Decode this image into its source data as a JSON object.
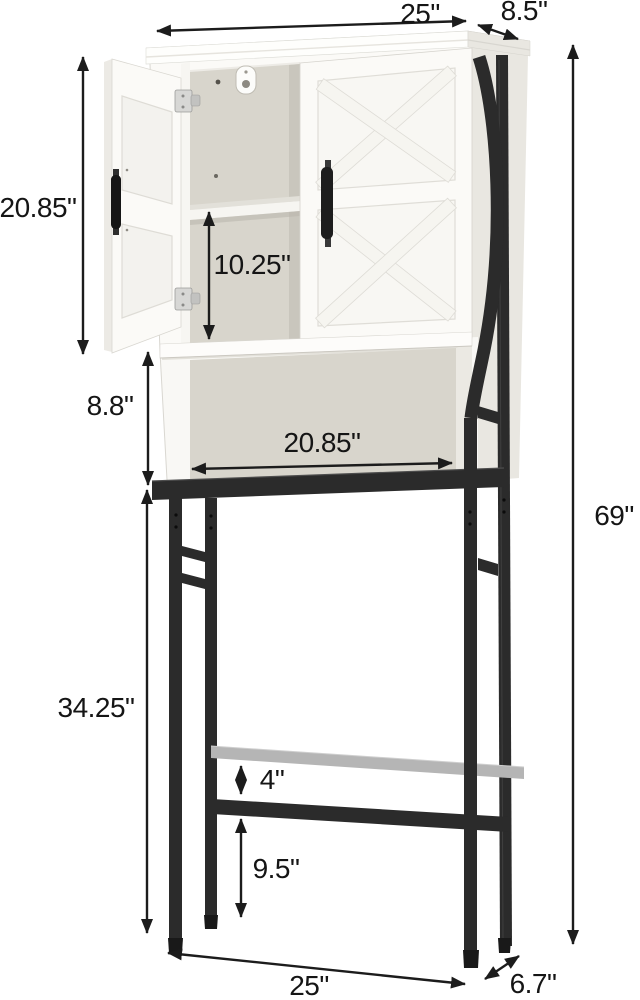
{
  "dims": {
    "top_width": "25\"",
    "top_depth": "8.5\"",
    "cabinet_height": "20.85\"",
    "interior_shelf_height": "10.25\"",
    "open_shelf_height": "8.8\"",
    "open_shelf_width": "20.85\"",
    "total_height": "69\"",
    "frame_leg_height": "34.25\"",
    "crossbar_gap": "4\"",
    "lower_crossbar_height": "9.5\"",
    "base_width": "25\"",
    "base_depth": "6.7\""
  },
  "colors": {
    "dim-line": "#1c1c1c",
    "metal": "#2b2b2b",
    "metal-dark": "#191919",
    "metal-light": "#4d4d4d",
    "silver-bar": "#b5b5b5",
    "cabinet-white": "#fbfaf7",
    "cabinet-shade": "#e9e7e1",
    "interior": "#d8d5cc",
    "interior-dark": "#c9c6bd",
    "panel": "#f3f2ee",
    "edge": "#d9d7d1"
  }
}
